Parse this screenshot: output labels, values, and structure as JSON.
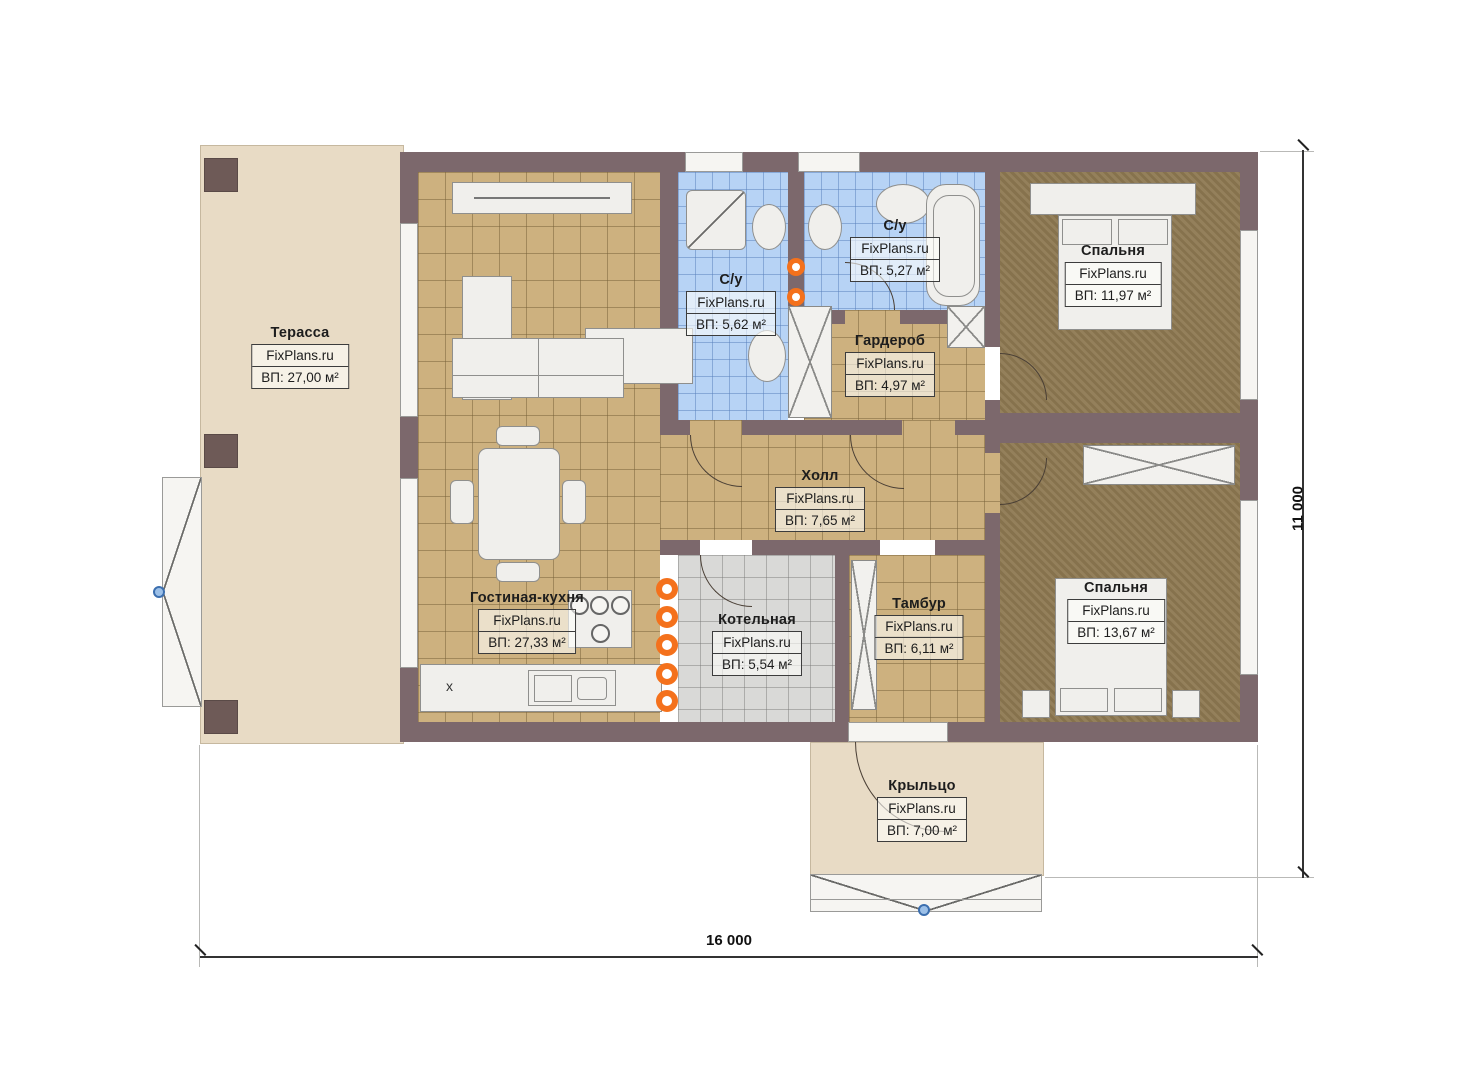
{
  "site": "FixPlans.ru",
  "rooms": [
    {
      "name": "Терасса",
      "site": "FixPlans.ru",
      "area": "ВП: 27,00 м²"
    },
    {
      "name": "Гостиная-кухня",
      "site": "FixPlans.ru",
      "area": "ВП: 27,33 м²"
    },
    {
      "name": "С/у",
      "site": "FixPlans.ru",
      "area": "ВП: 5,62 м²"
    },
    {
      "name": "С/у",
      "site": "FixPlans.ru",
      "area": "ВП: 5,27 м²"
    },
    {
      "name": "Гардероб",
      "site": "FixPlans.ru",
      "area": "ВП: 4,97 м²"
    },
    {
      "name": "Спальня",
      "site": "FixPlans.ru",
      "area": "ВП: 11,97 м²"
    },
    {
      "name": "Холл",
      "site": "FixPlans.ru",
      "area": "ВП: 7,65 м²"
    },
    {
      "name": "Котельная",
      "site": "FixPlans.ru",
      "area": "ВП: 5,54 м²"
    },
    {
      "name": "Тамбур",
      "site": "FixPlans.ru",
      "area": "ВП: 6,11 м²"
    },
    {
      "name": "Спальня",
      "site": "FixPlans.ru",
      "area": "ВП: 13,67 м²"
    },
    {
      "name": "Крыльцо",
      "site": "FixPlans.ru",
      "area": "ВП: 7,00 м²"
    }
  ],
  "dimensions": {
    "bottom": "16 000",
    "right": "11 000"
  },
  "markers": {
    "kitchen": "x"
  }
}
